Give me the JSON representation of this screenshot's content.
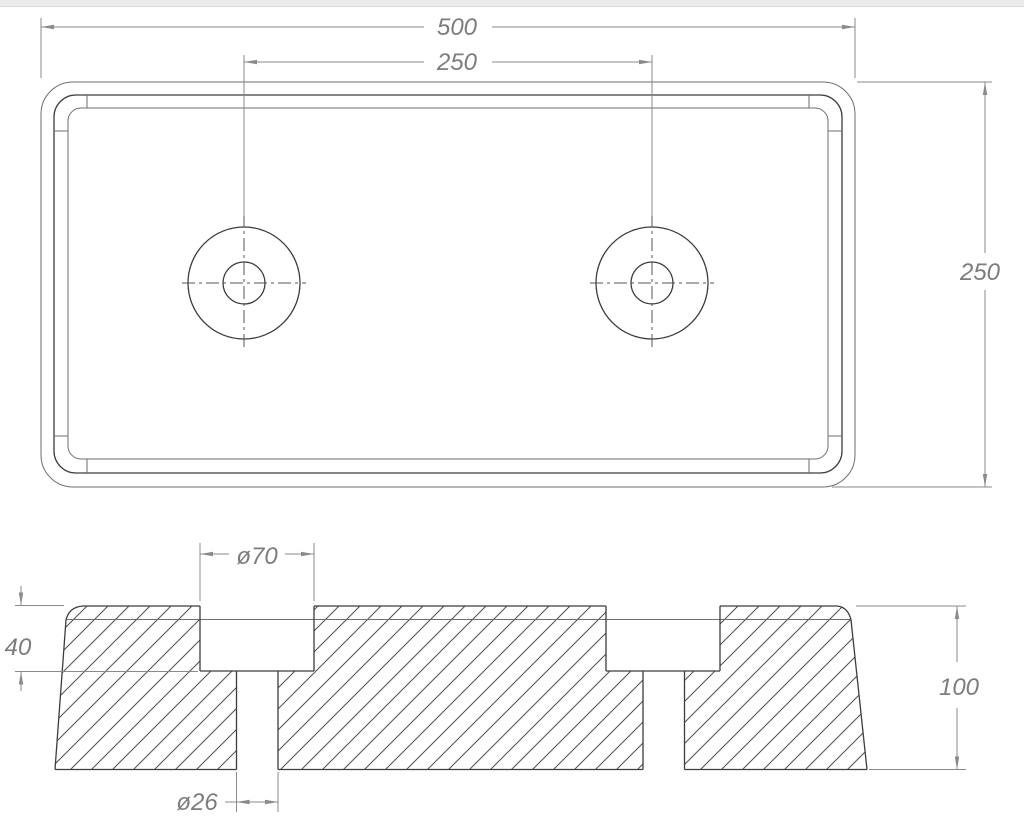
{
  "page": {
    "kind": "technical-drawing",
    "part": "rectangular pad with two counterbored holes, top view and sectional side view"
  },
  "colors": {
    "outline": "#3c3c3c",
    "thin_edge": "#6e6e6e",
    "dimension": "#8a8a8a",
    "centerline": "#555555",
    "hatch": "#4e4e4e",
    "text": "#7c7c7c",
    "background": "#ffffff",
    "top_strip": "#ececec",
    "top_strip_border": "#d9d9d9"
  },
  "dimensions": {
    "overall_width": {
      "label": "500"
    },
    "hole_spacing": {
      "label": "250"
    },
    "overall_depth": {
      "label": "250"
    },
    "counterbore_diameter": {
      "label": "ø70"
    },
    "counterbore_depth": {
      "label": "40"
    },
    "overall_height": {
      "label": "100"
    },
    "hole_diameter": {
      "label": "ø26"
    }
  }
}
